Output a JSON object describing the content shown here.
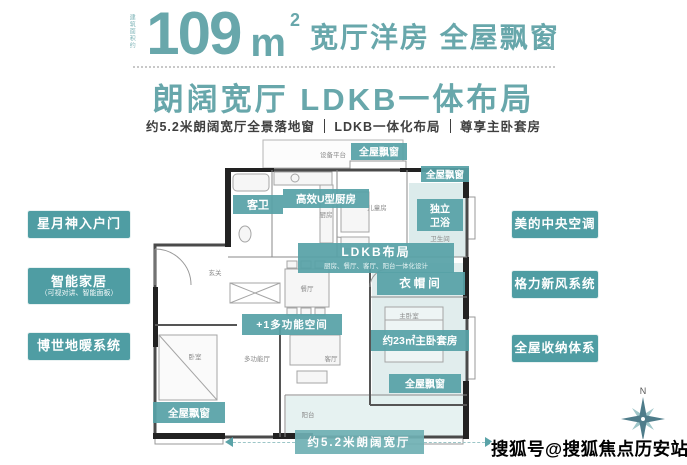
{
  "header": {
    "area_prefix": "建筑面积约",
    "area_number": "109",
    "area_unit": "m",
    "area_exponent": "2",
    "title_rest": "宽厅洋房 全屋飘窗",
    "subtitle": "朗阔宽厅 LDKB一体布局",
    "features": [
      "约5.2米朗阔宽厅全景落地窗",
      "LDKB一体化布局",
      "尊享主卧套房"
    ]
  },
  "left_panel": {
    "items": [
      {
        "label": "星月神入户门",
        "sub": ""
      },
      {
        "label": "智能家居",
        "sub": "（可视对讲、智能面板）"
      },
      {
        "label": "博世地暖系统",
        "sub": ""
      }
    ]
  },
  "right_panel": {
    "items": [
      {
        "label": "美的中央空调"
      },
      {
        "label": "格力新风系统"
      },
      {
        "label": "全屋收纳体系"
      }
    ]
  },
  "floorplan": {
    "equipment_platform": "设备平台",
    "labels": {
      "guest_bath": "客卫",
      "kitchen": "高效U型厨房",
      "kitchen_sub": "厨房",
      "bay_window": "全屋飘窗",
      "independent_bath_line1": "独立",
      "independent_bath_line2": "卫浴",
      "independent_bath_sub": "卫生间",
      "ldkb": "LDKB布局",
      "ldkb_sub": "厨房、餐厅、客厅、阳台一体化设计",
      "closet": "衣帽间",
      "multi_space": "+1多功能空间",
      "master_suite": "约23㎡主卧套房"
    },
    "rooms": {
      "children_room": "儿童房",
      "entry": "玄关",
      "dining": "餐厅",
      "bedroom": "卧室",
      "multi_hall": "多功能厅",
      "living": "客厅",
      "balcony": "阳台",
      "master_bedroom": "主卧室"
    },
    "dimension": "约5.2米朗阔宽厅"
  },
  "compass": {
    "north": "N"
  },
  "watermark": "搜狐号@搜狐焦点历安站",
  "colors": {
    "accent_teal": "#68a7ab",
    "tag_teal": "#4f9da3",
    "overlay_teal": "#57a1a7",
    "light_room_teal": "#dcebeb"
  }
}
